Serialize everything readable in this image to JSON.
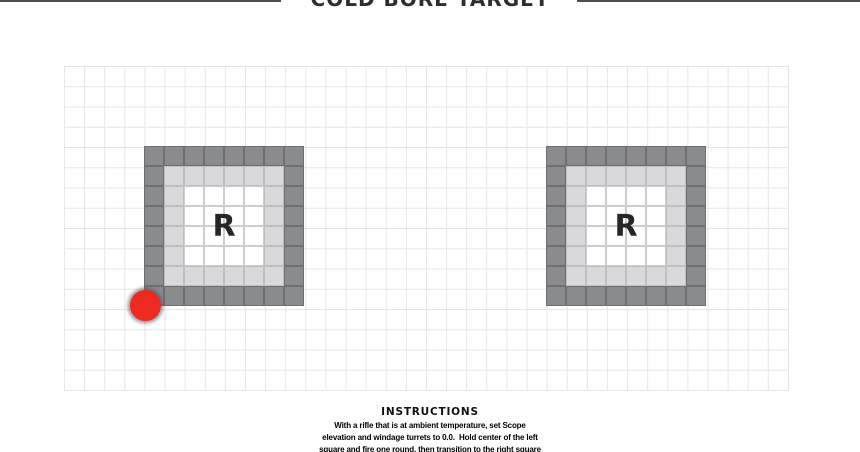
{
  "header": {
    "title": "COLD BORE TARGET"
  },
  "grid": {
    "columns": 36,
    "rows": 16
  },
  "targets": {
    "center_label": "R",
    "pattern": [
      "DDDDDDDD",
      "DLLLLLLD",
      "DLWWWWLD",
      "DLWWWWLD",
      "DLWWWWLD",
      "DLWWWWLD",
      "DLLLLLLD",
      "DDDDDDDD"
    ]
  },
  "shot_marker": {
    "location": "bottom-left corner of left target"
  },
  "instructions": {
    "title": "INSTRUCTIONS",
    "lines": [
      "With a rifle that is at ambient temperature, set Scope",
      "elevation and windage turrets to 0.0.  Hold center of the left",
      "square and fire one round, then transition to the right square"
    ]
  },
  "colors": {
    "dark-cell": "#8a8b8f",
    "light-cell": "#d9d9db",
    "white-cell": "#ffffff",
    "cell-border-dark": "#6f6f73",
    "cell-border-light": "#bfbfc1",
    "cell-border-white": "#cdcdcf",
    "marker-red": "#ee2a1f",
    "grid-line": "#e6e6e6",
    "rule-dark": "#4f4f4f",
    "text-dark": "#2d2d2d"
  }
}
